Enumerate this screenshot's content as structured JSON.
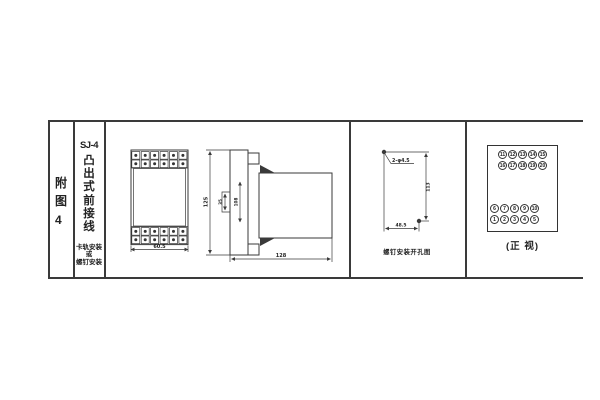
{
  "colors": {
    "line": "#3a3a3a",
    "text": "#222222",
    "background": "#ffffff"
  },
  "index_column": {
    "label_chars": [
      "附",
      "图",
      "4"
    ]
  },
  "title_column": {
    "model": "SJ-4",
    "title_chars": [
      "凸",
      "出",
      "式",
      "前",
      "接",
      "线"
    ],
    "mount_note_lines": [
      "卡轨安装",
      "或",
      "螺钉安装"
    ]
  },
  "outline_drawing": {
    "front_view": {
      "width_dim": "60.5",
      "terminal_cols": 6,
      "terminal_rows": 2
    },
    "side_view": {
      "height_dim": "125",
      "rail_dim": "35",
      "inner_dim": "108",
      "depth_dim": "128"
    }
  },
  "drilling_diagram": {
    "holes_label": "2-φ4.5",
    "vertical_dim": "113",
    "horizontal_dim": "48.5",
    "caption": "螺钉安装开孔图"
  },
  "terminal_view": {
    "top_rows": [
      [
        "11",
        "12",
        "13",
        "14",
        "15"
      ],
      [
        "16",
        "17",
        "18",
        "19",
        "20"
      ]
    ],
    "bottom_rows": [
      [
        "6",
        "7",
        "8",
        "9",
        "10"
      ],
      [
        "1",
        "2",
        "3",
        "4",
        "5"
      ]
    ],
    "caption": "(正 视)"
  }
}
